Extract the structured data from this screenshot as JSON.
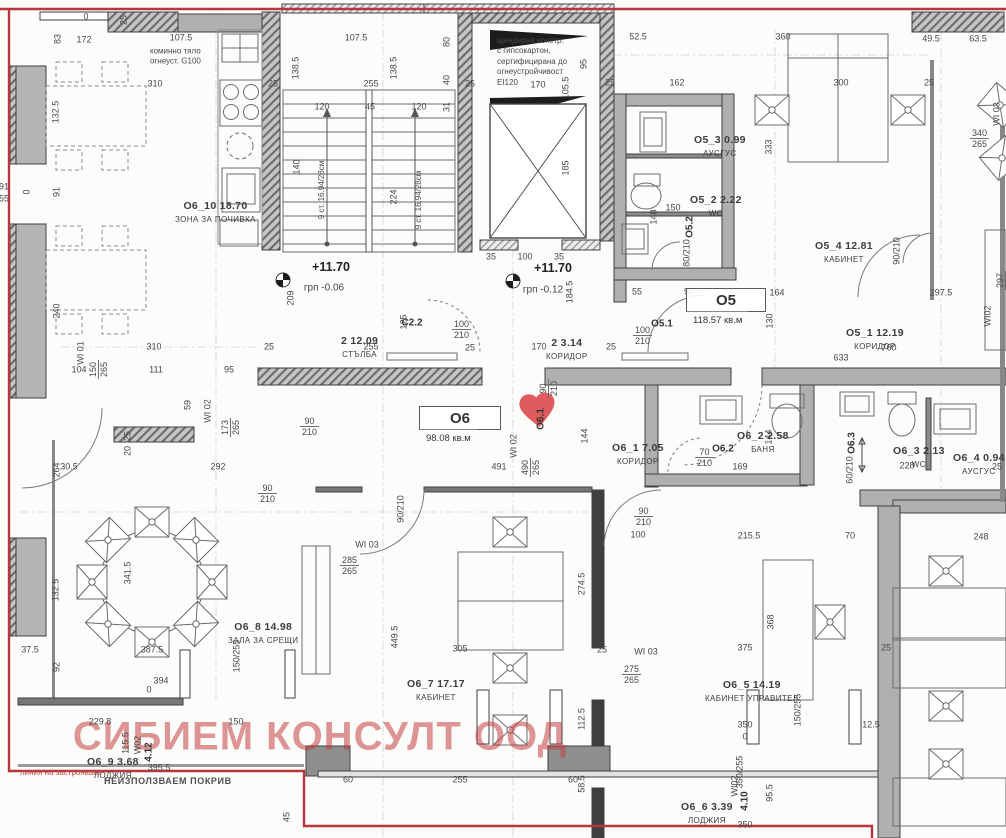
{
  "watermark": "СИБИЕМ КОНСУЛТ ООД",
  "colors": {
    "boundary_red": "#b6383c",
    "heart_red": "#df5b5e",
    "wall_gray": "#b0b0b0",
    "wall_dark": "#3f3f3f",
    "text": "#3d3d3d",
    "watermark_red": "#c23e42"
  },
  "units": [
    {
      "code": "О5",
      "area": "118.57 кв.м",
      "x": 686,
      "y": 288,
      "w": 78
    },
    {
      "code": "О6",
      "area": "98.08 кв.м",
      "x": 419,
      "y": 406,
      "w": 80
    }
  ],
  "rooms": [
    {
      "code": "О6_10",
      "area": "18.70",
      "name": "ЗОНА ЗА ПОЧИВКА",
      "x": 175,
      "y": 196
    },
    {
      "code": "2",
      "area": "12.09",
      "name": "СТЪЛБА",
      "x": 341,
      "y": 331
    },
    {
      "code": "2",
      "area": "3.14",
      "name": "КОРИДОР",
      "x": 546,
      "y": 333
    },
    {
      "code": "О5_3",
      "area": "0.99",
      "name": "АУСГУС",
      "x": 694,
      "y": 130
    },
    {
      "code": "О5_2",
      "area": "2.22",
      "name": "WC",
      "x": 690,
      "y": 190
    },
    {
      "code": "О5_4",
      "area": "12.81",
      "name": "КАБИНЕТ",
      "x": 815,
      "y": 236
    },
    {
      "code": "О5_1",
      "area": "12.19",
      "name": "КОРИДОР",
      "x": 846,
      "y": 323
    },
    {
      "code": "О6_1",
      "area": "7.05",
      "name": "КОРИДОР",
      "x": 612,
      "y": 438
    },
    {
      "code": "О6_2",
      "area": "2.58",
      "name": "БАНЯ",
      "x": 737,
      "y": 426
    },
    {
      "code": "О6_3",
      "area": "2.13",
      "name": "WC",
      "x": 893,
      "y": 441
    },
    {
      "code": "О6_4",
      "area": "0.94",
      "name": "АУСГУС",
      "x": 953,
      "y": 448
    },
    {
      "code": "О6_8",
      "area": "14.98",
      "name": "ЗАЛА ЗА СРЕЩИ",
      "x": 228,
      "y": 617
    },
    {
      "code": "О6_7",
      "area": "17.17",
      "name": "КАБИНЕТ",
      "x": 407,
      "y": 674
    },
    {
      "code": "О6_5",
      "area": "14.19",
      "name": "КАБИНЕТ УПРАВИТЕЛ",
      "x": 705,
      "y": 675
    },
    {
      "code": "О6_9",
      "area": "3.68",
      "name": "ЛОДЖИЯ",
      "x": 87,
      "y": 752
    },
    {
      "code": "О6_6",
      "area": "3.39",
      "name": "ЛОДЖИЯ",
      "x": 681,
      "y": 797
    }
  ],
  "doors": [
    {
      "t": "О5.1",
      "x": 662,
      "y": 324
    },
    {
      "t": "С2.2",
      "x": 412,
      "y": 323
    },
    {
      "t": "О5.2",
      "x": 690,
      "y": 227,
      "v": 1
    },
    {
      "t": "О6.2",
      "x": 723,
      "y": 449
    },
    {
      "t": "О6.3",
      "x": 852,
      "y": 443,
      "v": 1
    },
    {
      "t": "О6.1",
      "x": 541,
      "y": 419,
      "v": 1
    },
    {
      "t": "4.12",
      "x": 149,
      "y": 752,
      "v": 1
    },
    {
      "t": "4.10",
      "x": 745,
      "y": 801,
      "v": 1
    }
  ],
  "levels": [
    {
      "lvl": "+11.70",
      "sub": "грп  -0.06",
      "x": 331,
      "y": 267,
      "sx": 324,
      "sy": 288
    },
    {
      "lvl": "+11.70",
      "sub": "грп  -0.12",
      "x": 553,
      "y": 268,
      "sx": 543,
      "sy": 290
    }
  ],
  "notes": [
    {
      "t": "коминно тяло\nогнеуст. G100",
      "x": 150,
      "y": 57
    },
    {
      "t": "щендерна констр.\nс гипсокартон,\nсертифицирана до\nогнеустройчивост\nEI120",
      "x": 497,
      "y": 62
    },
    {
      "t": "9 ст. 16.94/28см",
      "x": 322,
      "y": 190,
      "v": 1
    },
    {
      "t": "9 ст. 16.94/28см",
      "x": 419,
      "y": 200,
      "v": 1
    },
    {
      "t": "линия на застрояване",
      "x": 20,
      "y": 773,
      "red": 1
    },
    {
      "t": "НЕИЗПОЛЗВАЕМ ПОКРИВ",
      "x": 104,
      "y": 782,
      "roof": 1
    }
  ],
  "dims": [
    {
      "t": "0",
      "x": 86,
      "y": 17
    },
    {
      "t": "25",
      "x": 124,
      "y": 20,
      "v": 1
    },
    {
      "t": "83",
      "x": 58,
      "y": 39,
      "v": 1
    },
    {
      "t": "172",
      "x": 84,
      "y": 40
    },
    {
      "t": "107.5",
      "x": 181,
      "y": 38
    },
    {
      "t": "107.5",
      "x": 356,
      "y": 38
    },
    {
      "t": "52.5",
      "x": 638,
      "y": 37
    },
    {
      "t": "360",
      "x": 783,
      "y": 37
    },
    {
      "t": "49.5",
      "x": 931,
      "y": 39
    },
    {
      "t": "63.5",
      "x": 978,
      "y": 39
    },
    {
      "t": "138.5",
      "x": 296,
      "y": 68,
      "v": 1
    },
    {
      "t": "138.5",
      "x": 394,
      "y": 68,
      "v": 1
    },
    {
      "t": "80",
      "x": 447,
      "y": 42,
      "v": 1
    },
    {
      "t": "95",
      "x": 584,
      "y": 64,
      "v": 1
    },
    {
      "t": "310",
      "x": 155,
      "y": 84
    },
    {
      "t": "25",
      "x": 273,
      "y": 84
    },
    {
      "t": "255",
      "x": 371,
      "y": 84
    },
    {
      "t": "40",
      "x": 447,
      "y": 80,
      "v": 1
    },
    {
      "t": "25",
      "x": 470,
      "y": 84
    },
    {
      "t": "170",
      "x": 538,
      "y": 85
    },
    {
      "t": "105.5",
      "x": 566,
      "y": 88,
      "v": 1
    },
    {
      "t": "25",
      "x": 610,
      "y": 83
    },
    {
      "t": "162",
      "x": 677,
      "y": 83
    },
    {
      "t": "300",
      "x": 841,
      "y": 83
    },
    {
      "t": "25",
      "x": 929,
      "y": 83
    },
    {
      "t": "120",
      "x": 322,
      "y": 107
    },
    {
      "t": "45",
      "x": 370,
      "y": 107
    },
    {
      "t": "120",
      "x": 419,
      "y": 107
    },
    {
      "t": "31",
      "x": 447,
      "y": 107,
      "v": 1
    },
    {
      "t": "132.5",
      "x": 56,
      "y": 112,
      "v": 1
    },
    {
      "t": "340",
      "t2": "265",
      "x": 970,
      "y": 128
    },
    {
      "t": "WI 03",
      "x": 997,
      "y": 114,
      "v": 1
    },
    {
      "t": "333",
      "x": 769,
      "y": 147,
      "v": 1
    },
    {
      "t": "140",
      "x": 297,
      "y": 167,
      "v": 1
    },
    {
      "t": "185",
      "x": 566,
      "y": 168,
      "v": 1
    },
    {
      "t": "91",
      "x": 57,
      "y": 192,
      "v": 1
    },
    {
      "t": "0",
      "x": 27,
      "y": 192,
      "v": 1
    },
    {
      "t": "91",
      "x": 4,
      "y": 187
    },
    {
      "t": "55",
      "x": 4,
      "y": 199
    },
    {
      "t": "224",
      "x": 394,
      "y": 197,
      "v": 1
    },
    {
      "t": "150",
      "x": 673,
      "y": 208
    },
    {
      "t": "148",
      "x": 654,
      "y": 217,
      "v": 1
    },
    {
      "t": "80/210",
      "x": 687,
      "y": 253,
      "v": 1
    },
    {
      "t": "90/210",
      "x": 897,
      "y": 251,
      "v": 1
    },
    {
      "t": "240",
      "x": 57,
      "y": 311,
      "v": 1
    },
    {
      "t": "35",
      "x": 491,
      "y": 257
    },
    {
      "t": "100",
      "x": 525,
      "y": 257
    },
    {
      "t": "35",
      "x": 559,
      "y": 257
    },
    {
      "t": "209",
      "x": 291,
      "y": 298,
      "v": 1
    },
    {
      "t": "184.5",
      "x": 570,
      "y": 292,
      "v": 1
    },
    {
      "t": "55",
      "x": 637,
      "y": 292
    },
    {
      "t": "90",
      "x": 689,
      "y": 292
    },
    {
      "t": "164",
      "x": 777,
      "y": 293
    },
    {
      "t": "297.5",
      "x": 941,
      "y": 293
    },
    {
      "t": "130",
      "x": 770,
      "y": 321,
      "v": 1
    },
    {
      "t": "297",
      "t2": "265",
      "x": 995,
      "y": 290,
      "v": 1
    },
    {
      "t": "WI02",
      "x": 988,
      "y": 316,
      "v": 1
    },
    {
      "t": "100",
      "t2": "210",
      "x": 452,
      "y": 319
    },
    {
      "t": "100",
      "t2": "210",
      "x": 633,
      "y": 325
    },
    {
      "t": "25",
      "x": 269,
      "y": 347
    },
    {
      "t": "255",
      "x": 371,
      "y": 347
    },
    {
      "t": "125",
      "x": 404,
      "y": 322,
      "v": 1
    },
    {
      "t": "25",
      "x": 470,
      "y": 348
    },
    {
      "t": "170",
      "x": 539,
      "y": 347
    },
    {
      "t": "25",
      "x": 611,
      "y": 347
    },
    {
      "t": "310",
      "x": 154,
      "y": 347
    },
    {
      "t": "760",
      "x": 889,
      "y": 348
    },
    {
      "t": "633",
      "x": 841,
      "y": 358
    },
    {
      "t": "104",
      "x": 79,
      "y": 370
    },
    {
      "t": "111",
      "x": 156,
      "y": 370
    },
    {
      "t": "95",
      "x": 229,
      "y": 370
    },
    {
      "t": "WI 01",
      "x": 81,
      "y": 353,
      "v": 1
    },
    {
      "t": "150",
      "t2": "265",
      "x": 88,
      "y": 379,
      "v": 1
    },
    {
      "t": "59",
      "x": 188,
      "y": 405,
      "v": 1
    },
    {
      "t": "WI 02",
      "x": 208,
      "y": 411,
      "v": 1
    },
    {
      "t": "90",
      "t2": "210",
      "x": 300,
      "y": 416
    },
    {
      "t": "173",
      "t2": "265",
      "x": 220,
      "y": 437,
      "v": 1
    },
    {
      "t": "25",
      "x": 128,
      "y": 436,
      "v": 1
    },
    {
      "t": "20",
      "x": 128,
      "y": 451,
      "v": 1
    },
    {
      "t": "90",
      "t2": "210",
      "x": 538,
      "y": 398,
      "v": 1
    },
    {
      "t": "WI 02",
      "x": 514,
      "y": 446,
      "v": 1
    },
    {
      "t": "144",
      "x": 585,
      "y": 436,
      "v": 1
    },
    {
      "t": "144",
      "x": 769,
      "y": 437,
      "v": 1
    },
    {
      "t": "70",
      "t2": "210",
      "x": 695,
      "y": 447
    },
    {
      "t": "60/210",
      "x": 850,
      "y": 470,
      "v": 1
    },
    {
      "t": "169",
      "x": 740,
      "y": 467
    },
    {
      "t": "228",
      "x": 907,
      "y": 466
    },
    {
      "t": "25",
      "x": 997,
      "y": 467
    },
    {
      "t": "491",
      "x": 499,
      "y": 467
    },
    {
      "t": "490",
      "t2": "265",
      "x": 520,
      "y": 477,
      "v": 1
    },
    {
      "t": "264",
      "x": 57,
      "y": 470,
      "v": 1
    },
    {
      "t": "30.5",
      "x": 69,
      "y": 467
    },
    {
      "t": "292",
      "x": 218,
      "y": 467
    },
    {
      "t": "90",
      "t2": "210",
      "x": 258,
      "y": 483
    },
    {
      "t": "341.5",
      "x": 128,
      "y": 573,
      "v": 1
    },
    {
      "t": "132.5",
      "x": 56,
      "y": 590,
      "v": 1
    },
    {
      "t": "285",
      "t2": "265",
      "x": 340,
      "y": 555
    },
    {
      "t": "WI 03",
      "x": 367,
      "y": 545
    },
    {
      "t": "90/210",
      "x": 401,
      "y": 509,
      "v": 1
    },
    {
      "t": "90",
      "t2": "210",
      "x": 634,
      "y": 506
    },
    {
      "t": "100",
      "x": 638,
      "y": 535
    },
    {
      "t": "215.5",
      "x": 749,
      "y": 536
    },
    {
      "t": "70",
      "x": 850,
      "y": 536
    },
    {
      "t": "248",
      "x": 981,
      "y": 537
    },
    {
      "t": "274.5",
      "x": 582,
      "y": 584,
      "v": 1
    },
    {
      "t": "368",
      "x": 771,
      "y": 622,
      "v": 1
    },
    {
      "t": "37.5",
      "x": 30,
      "y": 650
    },
    {
      "t": "387.5",
      "x": 152,
      "y": 650
    },
    {
      "t": "92",
      "x": 57,
      "y": 667,
      "v": 1
    },
    {
      "t": "150/255",
      "x": 237,
      "y": 656,
      "v": 1
    },
    {
      "t": "394",
      "x": 161,
      "y": 681
    },
    {
      "t": "0",
      "x": 149,
      "y": 690
    },
    {
      "t": "449.5",
      "x": 395,
      "y": 637,
      "v": 1
    },
    {
      "t": "305",
      "x": 460,
      "y": 649
    },
    {
      "t": "25",
      "x": 602,
      "y": 650
    },
    {
      "t": "375",
      "x": 745,
      "y": 648
    },
    {
      "t": "25",
      "x": 886,
      "y": 648
    },
    {
      "t": "275",
      "t2": "265",
      "x": 622,
      "y": 664
    },
    {
      "t": "WI 03",
      "x": 646,
      "y": 652
    },
    {
      "t": "112.5",
      "x": 582,
      "y": 719,
      "v": 1
    },
    {
      "t": "150/255",
      "x": 798,
      "y": 710,
      "v": 1
    },
    {
      "t": "350",
      "x": 745,
      "y": 725
    },
    {
      "t": "0",
      "x": 745,
      "y": 737
    },
    {
      "t": "12.5",
      "x": 871,
      "y": 725
    },
    {
      "t": "229.8",
      "x": 100,
      "y": 722
    },
    {
      "t": "150",
      "x": 236,
      "y": 722
    },
    {
      "t": "115.5",
      "x": 126,
      "y": 743,
      "v": 1
    },
    {
      "t": "W02",
      "x": 138,
      "y": 745,
      "v": 1
    },
    {
      "t": "395.5",
      "x": 159,
      "y": 768
    },
    {
      "t": "45",
      "x": 287,
      "y": 817,
      "v": 1
    },
    {
      "t": "60",
      "x": 348,
      "y": 780
    },
    {
      "t": "255",
      "x": 460,
      "y": 780
    },
    {
      "t": "60",
      "x": 573,
      "y": 780
    },
    {
      "t": "58.5",
      "x": 582,
      "y": 784,
      "v": 1
    },
    {
      "t": "350/255",
      "x": 740,
      "y": 772,
      "v": 1
    },
    {
      "t": "WI02",
      "x": 735,
      "y": 786,
      "v": 1
    },
    {
      "t": "95.5",
      "x": 770,
      "y": 793,
      "v": 1
    },
    {
      "t": "350",
      "x": 745,
      "y": 825
    }
  ]
}
